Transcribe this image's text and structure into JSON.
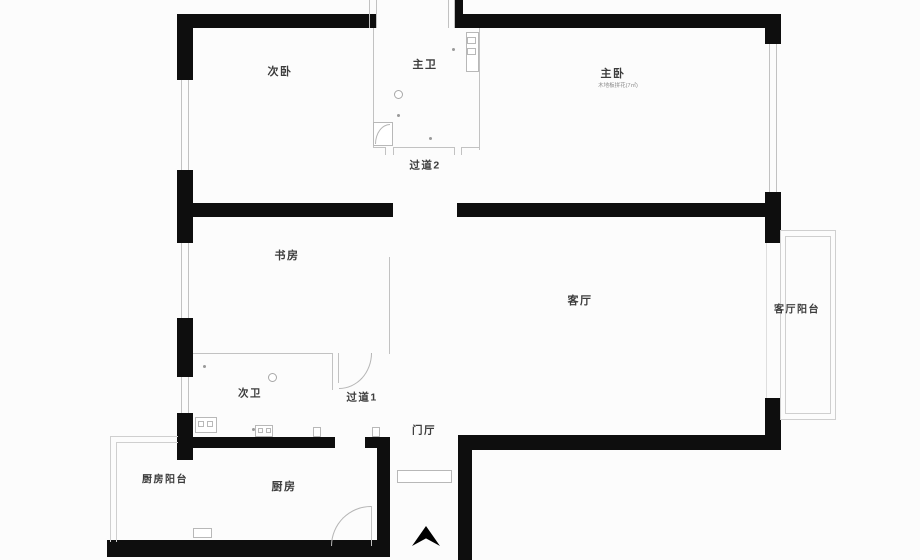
{
  "title": "apartment-floor-plan",
  "colors": {
    "background": "#fcfcfc",
    "wall": "#0e0e0e",
    "thin_line": "#c2c2c2",
    "label_text": "#3c3c3c",
    "note_text": "#8a8a8a"
  },
  "labels": [
    {
      "id": "second-bedroom",
      "text": "次卧"
    },
    {
      "id": "master-bathroom",
      "text": "主卫"
    },
    {
      "id": "master-bedroom",
      "text": "主卧"
    },
    {
      "id": "master-bedroom-note",
      "text": "木地板拼花(7㎡)"
    },
    {
      "id": "hallway-2",
      "text": "过道2"
    },
    {
      "id": "study",
      "text": "书房"
    },
    {
      "id": "living-room",
      "text": "客厅"
    },
    {
      "id": "living-room-balcony",
      "text": "客厅阳台"
    },
    {
      "id": "second-bathroom",
      "text": "次卫"
    },
    {
      "id": "hallway-1",
      "text": "过道1"
    },
    {
      "id": "entry-hall",
      "text": "门厅"
    },
    {
      "id": "kitchen-balcony",
      "text": "厨房阳台"
    },
    {
      "id": "kitchen",
      "text": "厨房"
    }
  ],
  "geometry": {
    "walls": [
      [
        177,
        14,
        200,
        14
      ],
      [
        455,
        14,
        326,
        14
      ],
      [
        455,
        0,
        8,
        14
      ],
      [
        177,
        14,
        16,
        66
      ],
      [
        177,
        170,
        16,
        73
      ],
      [
        177,
        318,
        16,
        59
      ],
      [
        177,
        413,
        16,
        47
      ],
      [
        765,
        14,
        16,
        30
      ],
      [
        765,
        192,
        16,
        51
      ],
      [
        765,
        398,
        16,
        52
      ],
      [
        193,
        203,
        200,
        14
      ],
      [
        457,
        203,
        308,
        14
      ],
      [
        458,
        435,
        319,
        15
      ],
      [
        458,
        435,
        14,
        125
      ],
      [
        180,
        437,
        155,
        11
      ],
      [
        365,
        437,
        25,
        11
      ],
      [
        377,
        437,
        13,
        113
      ],
      [
        107,
        540,
        283,
        17
      ]
    ],
    "window_lines": [
      [
        181,
        80,
        1,
        90
      ],
      [
        188,
        80,
        1,
        90
      ],
      [
        181,
        243,
        1,
        75
      ],
      [
        188,
        243,
        1,
        75
      ],
      [
        181,
        377,
        1,
        36
      ],
      [
        188,
        377,
        1,
        36
      ],
      [
        769,
        44,
        1,
        148
      ],
      [
        776,
        44,
        1,
        148
      ],
      [
        369,
        0,
        1,
        28
      ],
      [
        376,
        0,
        1,
        28
      ],
      [
        448,
        0,
        1,
        28
      ],
      [
        454,
        0,
        1,
        28
      ]
    ],
    "thin_lines": [
      [
        373,
        28,
        1,
        120
      ],
      [
        479,
        28,
        1,
        122
      ],
      [
        373,
        147,
        13,
        1
      ],
      [
        394,
        147,
        60,
        1
      ],
      [
        461,
        147,
        19,
        1
      ],
      [
        385,
        147,
        1,
        8
      ],
      [
        393,
        147,
        1,
        8
      ],
      [
        454,
        147,
        1,
        8
      ],
      [
        461,
        147,
        1,
        8
      ],
      [
        193,
        353,
        140,
        1
      ],
      [
        389,
        257,
        1,
        97
      ],
      [
        332,
        353,
        1,
        37
      ],
      [
        338,
        353,
        1,
        30
      ],
      [
        371,
        506,
        1,
        40
      ]
    ],
    "light_lines": [
      [
        766,
        243,
        1,
        155
      ]
    ],
    "fixture_boxes": [
      [
        466,
        32,
        13,
        40
      ],
      [
        467,
        37,
        9,
        7
      ],
      [
        467,
        48,
        9,
        7
      ],
      [
        373,
        122,
        20,
        24
      ],
      [
        195,
        417,
        22,
        16
      ],
      [
        198,
        421,
        6,
        6
      ],
      [
        207,
        421,
        6,
        6
      ],
      [
        193,
        528,
        19,
        10
      ],
      [
        255,
        425,
        18,
        12
      ],
      [
        258,
        428,
        5,
        5
      ],
      [
        266,
        428,
        5,
        5
      ],
      [
        313,
        427,
        8,
        10
      ],
      [
        372,
        427,
        8,
        10
      ]
    ],
    "outline_boxes": [
      [
        780,
        230,
        56,
        190
      ],
      [
        785,
        236,
        46,
        178
      ]
    ],
    "open_boxes": [
      [
        110,
        436,
        68,
        106
      ],
      [
        116,
        442,
        62,
        100
      ]
    ],
    "circles": [
      [
        394,
        90,
        9,
        9
      ],
      [
        268,
        373,
        9,
        9
      ]
    ],
    "dots": [
      [
        452,
        48,
        3,
        3
      ],
      [
        397,
        114,
        3,
        3
      ],
      [
        429,
        137,
        3,
        3
      ],
      [
        203,
        365,
        3,
        3
      ],
      [
        252,
        428,
        3,
        3
      ]
    ],
    "arcs": [
      {
        "x": 375,
        "y": 124,
        "w": 15,
        "h": 20,
        "kind": "tl"
      },
      {
        "x": 339,
        "y": 353,
        "w": 33,
        "h": 36,
        "kind": "br"
      },
      {
        "x": 331,
        "y": 506,
        "w": 40,
        "h": 40,
        "kind": "tl"
      }
    ],
    "entrance": {
      "door": [
        397,
        470,
        55,
        13
      ],
      "arrow": [
        412,
        526,
        28,
        20
      ]
    }
  }
}
